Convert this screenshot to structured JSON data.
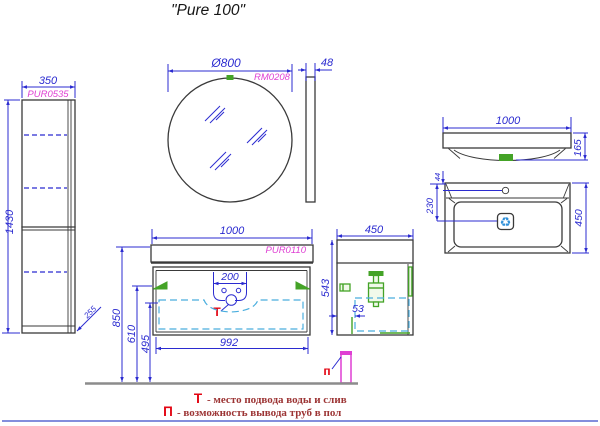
{
  "title": "\"Pure 100\"",
  "colors": {
    "outline": "#3a3a3a",
    "dimension": "#2b2bd0",
    "code": "#df3fd3",
    "detail_green": "#44a327",
    "dash_cyan": "#4aaede",
    "marker_red": "#e30613",
    "legend_maroon": "#9c3434",
    "floor_gray": "#8c8c8c",
    "border_blue": "#5a68d2",
    "drain_blue": "#2f8fd8"
  },
  "tall_cabinet": {
    "code": "PUR0535",
    "width_label": "350",
    "height_label": "1430",
    "depth_label": "255"
  },
  "mirror": {
    "code": "RM0208",
    "diameter_label": "Ø800",
    "thickness_label": "48"
  },
  "vanity_front": {
    "code": "PUR0110",
    "width_label": "1000",
    "cutout_label": "200",
    "bottom_width_label": "992",
    "height_total_label": "850",
    "height_countertop_label": "610",
    "height_drawer_label": "495",
    "water_marker": "Т"
  },
  "vanity_side": {
    "depth_label": "450",
    "height_label": "543",
    "pipe_offset_label": "53",
    "floor_pipe_marker": "п"
  },
  "sink_front": {
    "width_label": "1000",
    "height_label": "165"
  },
  "sink_top": {
    "depth_label": "450",
    "drain_offset_label": "230",
    "faucet_offset_label": "44",
    "drain_icon": "♻"
  },
  "legend": {
    "items": [
      {
        "marker": "Т",
        "text": "- место подвода воды и слив"
      },
      {
        "marker": "П",
        "text": "- возможность вывода труб в пол"
      }
    ]
  }
}
